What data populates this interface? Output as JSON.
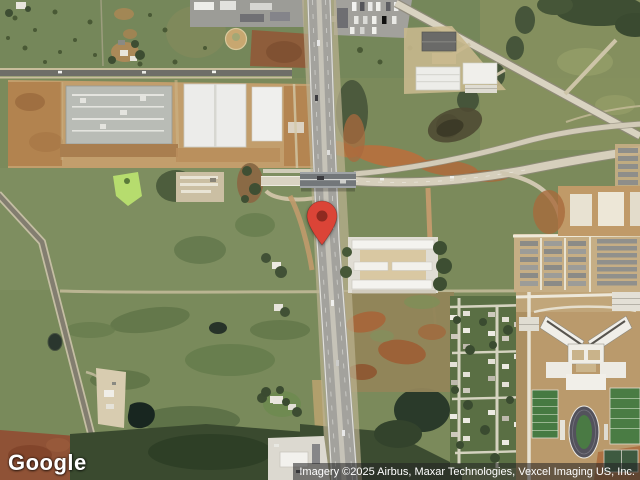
{
  "map": {
    "view_type": "satellite",
    "pin_color": "#DB4437",
    "pin_inner_color": "#8E2A20"
  },
  "branding": {
    "logo_text": "Google"
  },
  "attribution": {
    "text": "Imagery ©2025 Airbus, Maxar Technologies, Vexcel Imaging US, Inc."
  }
}
